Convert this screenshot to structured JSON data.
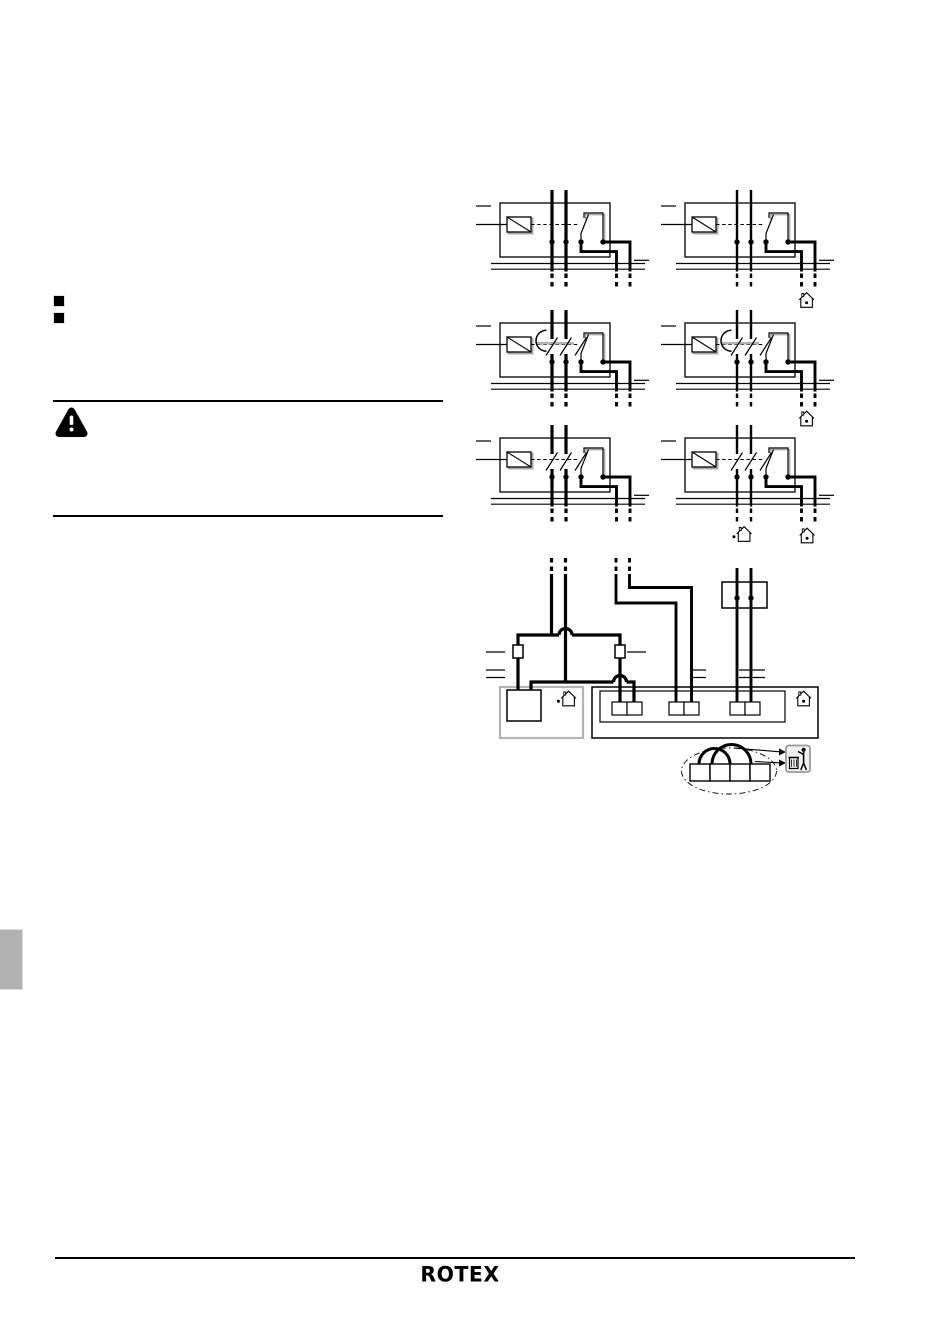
{
  "footer": {
    "logo": "ROTEX"
  },
  "colors": {
    "ink": "#000000",
    "shadow_gray": "#a9a9a9",
    "connector_gray": "#b3b3b3",
    "side_tab_gray": "#b2b2b2",
    "dispose_icon_border": "#9a9a9a",
    "dispose_icon_bg": "#f2f2f2"
  },
  "icons": {
    "warning": "warning-triangle-icon",
    "house_dot_inside": "house-icon",
    "house_dot_left": "house-icon-dot-left",
    "dispose": "dispose-in-trash-icon"
  },
  "marks": {
    "bullet_count": 2,
    "relay_diagram_count": 6,
    "terminal_pair_count": 3,
    "jumper_bridge_count": 2
  }
}
